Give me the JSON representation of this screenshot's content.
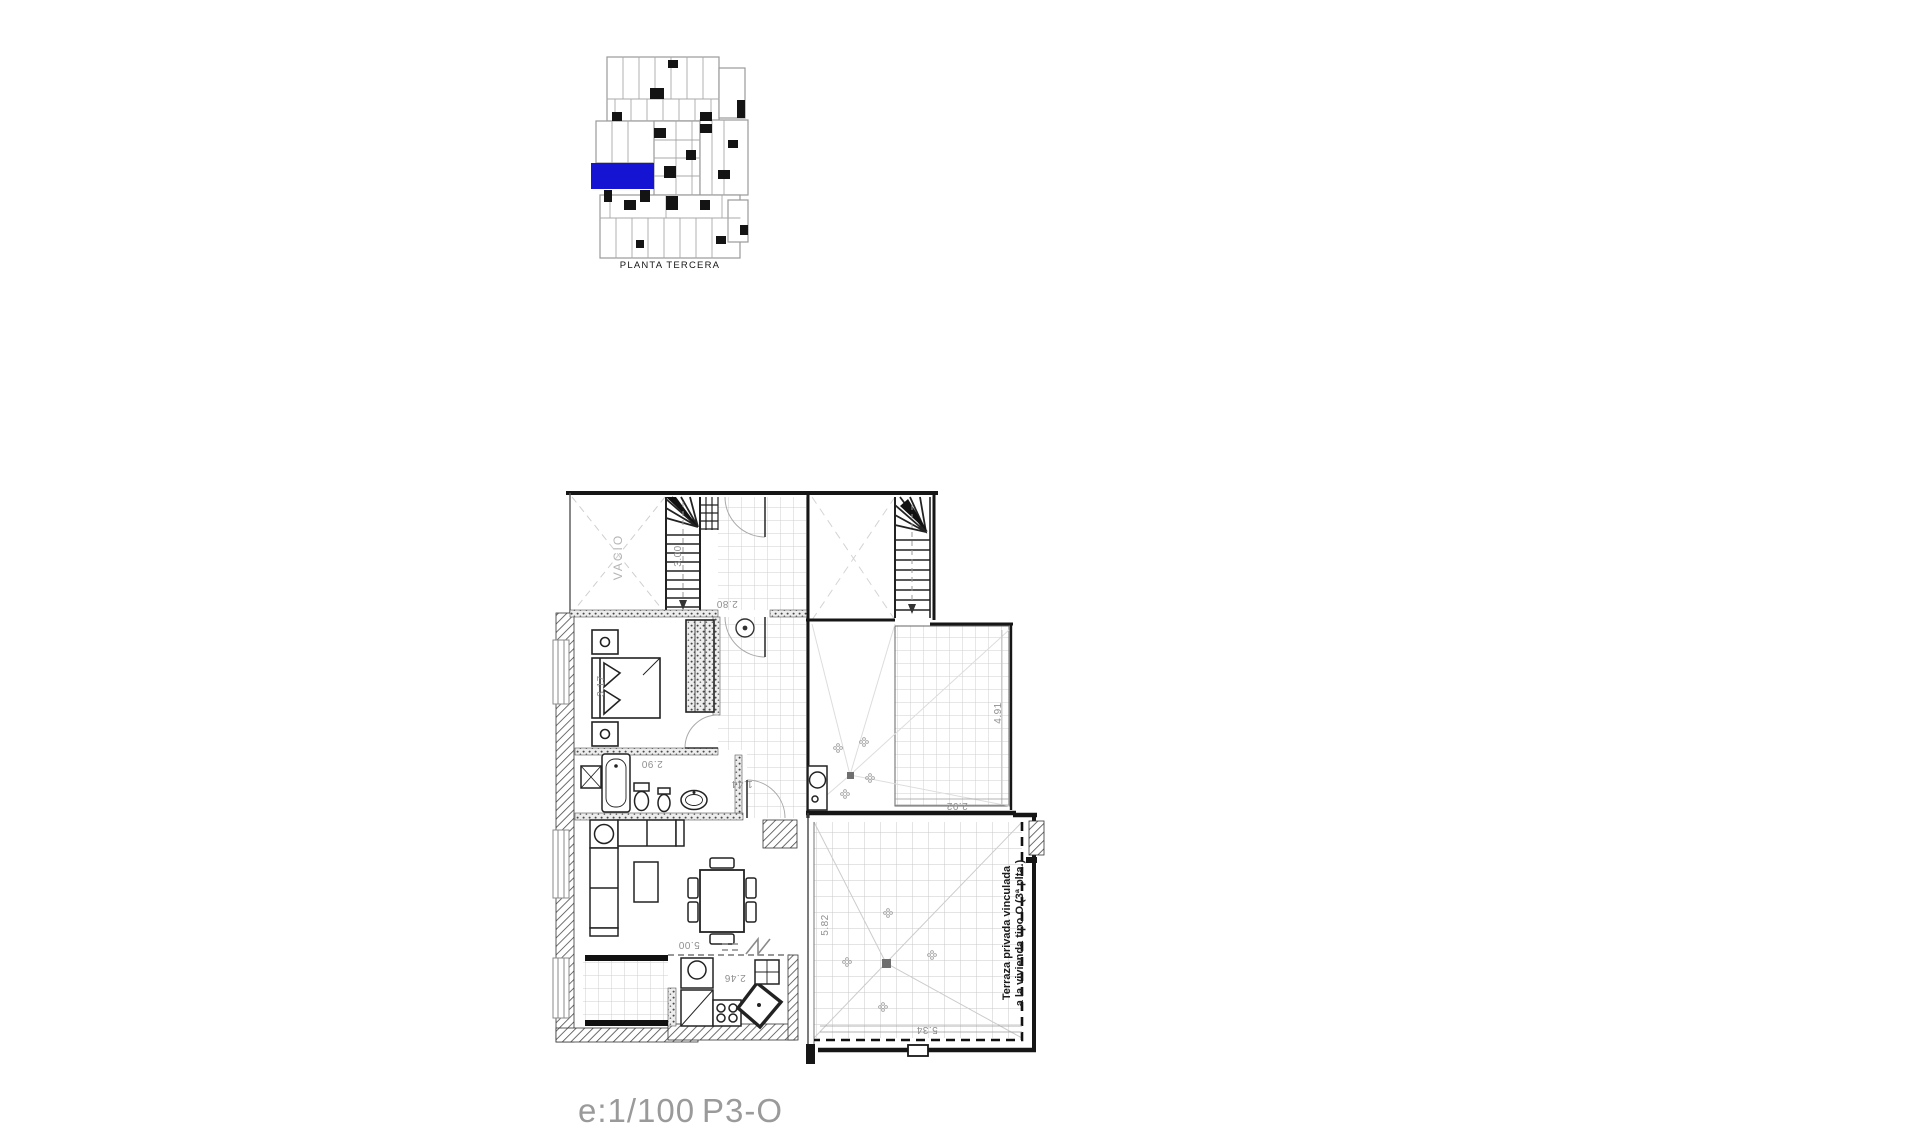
{
  "overview": {
    "label": "PLANTA TERCERA",
    "highlight_color": "#1414d2"
  },
  "plan": {
    "void_label": "VACIO",
    "terrace_note": {
      "line1": "Terraza privada vinculada",
      "line2": "a la vivienda tipo O (3ª plta.)"
    },
    "dimensions": {
      "stair": "3.00",
      "landing_width": "2.80",
      "bedroom_width": "3.17",
      "bathroom_width": "2.90",
      "hall_width": "1.44",
      "living_width": "5.00",
      "kitchen_width": "2.46",
      "upper_terrace_depth": "4.91",
      "upper_terrace_width": "2.92",
      "terrace_depth": "5.82",
      "terrace_width": "5.34"
    }
  },
  "footer": {
    "scale": "e:1/100",
    "code": "P3-O"
  },
  "colors": {
    "line": "#1a1a1a",
    "tile": "#cccccc",
    "faint": "#d9d9d9"
  }
}
